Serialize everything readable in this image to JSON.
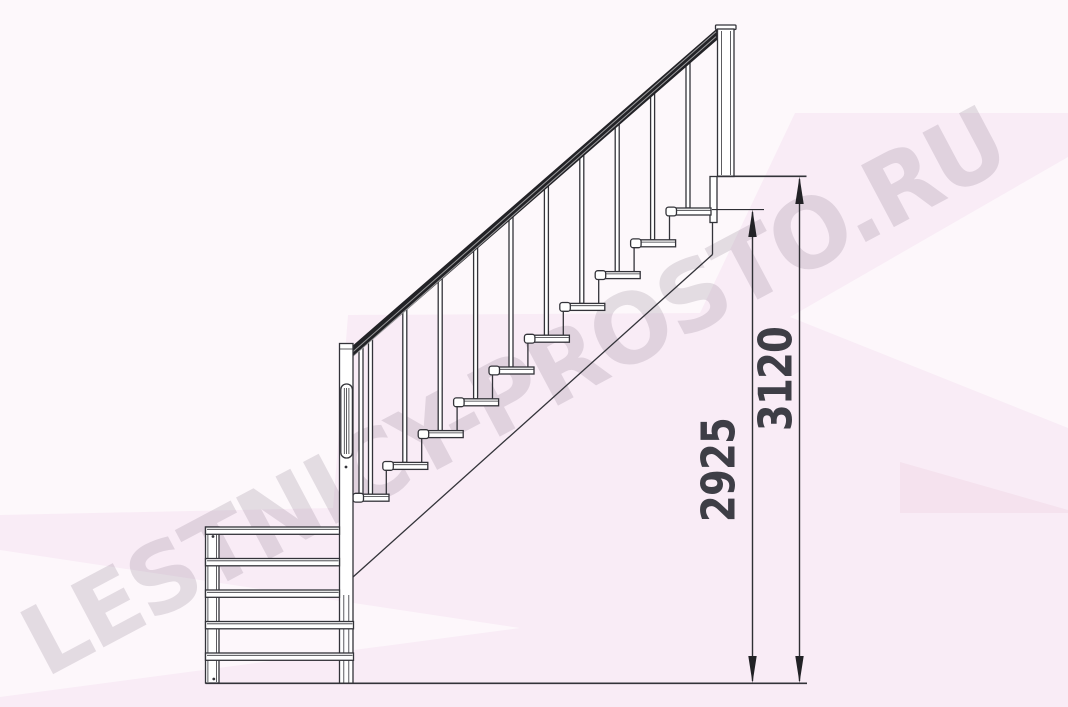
{
  "watermark": {
    "text": "LESTNICY-PROSTO.RU"
  },
  "dimensions": {
    "overall_height": "3120",
    "floor_to_top_tread": "2925"
  },
  "drawing": {
    "type": "staircase-side-elevation",
    "main_flight_treads": 10,
    "lower_flight_treads": 5
  },
  "colors": {
    "background_pink": "#f9ecf6",
    "line": "#333339",
    "handrail": "#222226",
    "dimension_text": "#3e3e46",
    "watermark_text": "#7d7080"
  }
}
